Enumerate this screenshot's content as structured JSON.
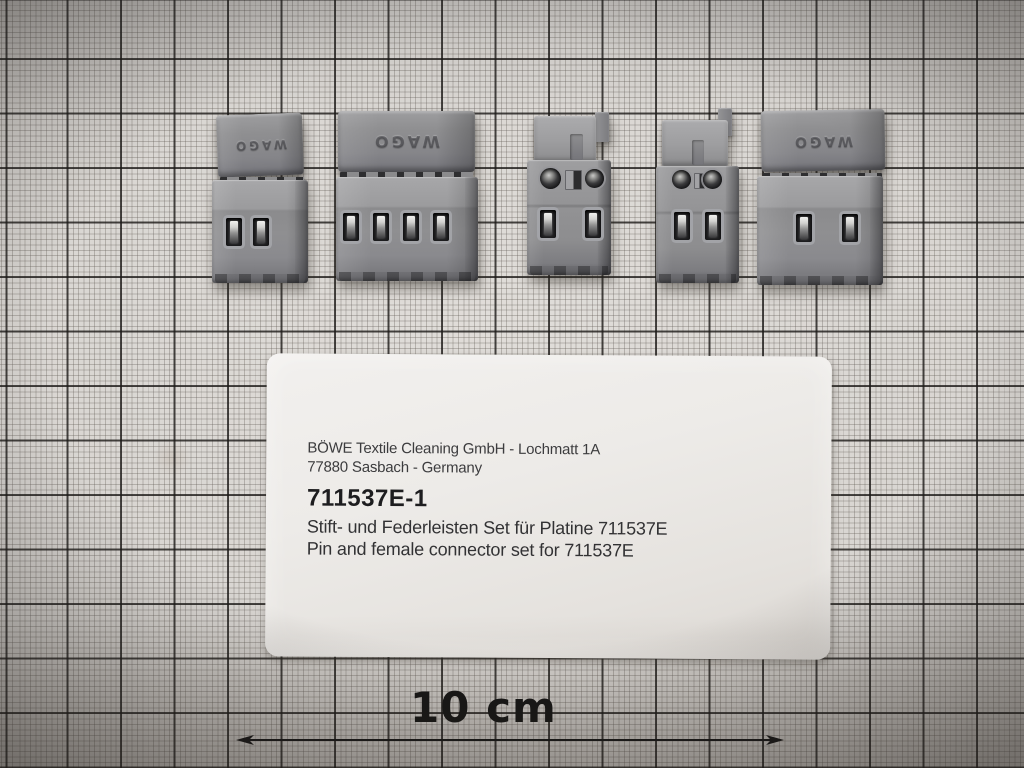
{
  "scale": {
    "label": "10 cm"
  },
  "label_card": {
    "address_line1": "BÖWE Textile Cleaning GmbH - Lochmatt 1A",
    "address_line2": "77880 Sasbach - Germany",
    "part_number": "711537E-1",
    "description_de": "Stift- und Federleisten Set für Platine 711537E",
    "description_en": "Pin and female connector set for 711537E"
  },
  "connectors": [
    {
      "id": "connector-1",
      "style": "cap-side",
      "poles": 2,
      "embossed_text": "WAGO"
    },
    {
      "id": "connector-2",
      "style": "cap-side",
      "poles": 4,
      "embossed_text": "WAGO"
    },
    {
      "id": "connector-3",
      "style": "latch-side",
      "poles": 2,
      "embossed_text": ""
    },
    {
      "id": "connector-4",
      "style": "latch-side",
      "poles": 2,
      "embossed_text": ""
    },
    {
      "id": "connector-5",
      "style": "cap-side",
      "poles": 2,
      "embossed_text": "WAGO"
    }
  ],
  "colors": {
    "paper": "#d8d5d1",
    "grid_major": "#1c1a18",
    "grid_minor": "#645e58",
    "connector_gray": "#8d8d8f",
    "card_white": "#edebe8",
    "text_black": "#1d1d1f"
  }
}
